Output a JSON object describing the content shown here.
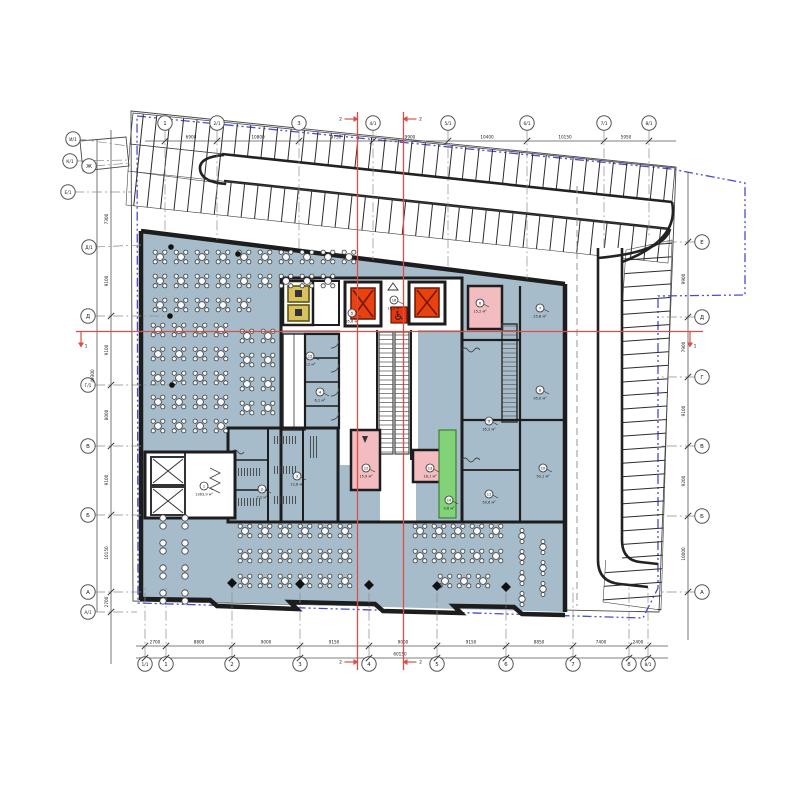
{
  "title": "План этажа — схема расстановки (floor plan with dining layout, core and parking)",
  "colors": {
    "floor": "#a7bcca",
    "wall": "#1d1d1d",
    "elevator_red": "#e8430e",
    "accent_red": "#d94f43",
    "stair_pink": "#f2bcc0",
    "exit_green": "#82d378",
    "dumbwaiter_yellow": "#d9c15e",
    "property_blue": "#4a4ad2"
  },
  "axes": {
    "top": {
      "y": 123,
      "items": [
        {
          "label": "1",
          "x": 165,
          "y2": 233
        },
        {
          "label": "2/1",
          "x": 217,
          "y2": 240
        },
        {
          "label": "3",
          "x": 299,
          "y2": 250
        },
        {
          "label": "4/1",
          "x": 373,
          "y2": 260
        },
        {
          "label": "5/1",
          "x": 448,
          "y2": 269
        },
        {
          "label": "6/1",
          "x": 527,
          "y2": 279
        },
        {
          "label": "7/1",
          "x": 604,
          "y2": 250
        },
        {
          "label": "8/1",
          "x": 649,
          "y2": 238
        }
      ]
    },
    "bottom": {
      "y": 664,
      "items": [
        {
          "label": "1/1",
          "x": 145
        },
        {
          "label": "1",
          "x": 166
        },
        {
          "label": "2",
          "x": 232
        },
        {
          "label": "3",
          "x": 300
        },
        {
          "label": "4",
          "x": 369
        },
        {
          "label": "5",
          "x": 437
        },
        {
          "label": "6",
          "x": 506
        },
        {
          "label": "7",
          "x": 573
        },
        {
          "label": "8",
          "x": 629
        },
        {
          "label": "8/1",
          "x": 648
        }
      ]
    },
    "left": {
      "x": 88,
      "items": [
        {
          "label": "Д",
          "y": 316,
          "x2": 168
        },
        {
          "label": "Г/1",
          "y": 385,
          "x2": 170
        },
        {
          "label": "В",
          "y": 446,
          "x2": 141
        },
        {
          "label": "Б",
          "y": 515,
          "x2": 141
        },
        {
          "label": "А",
          "y": 592,
          "x2": 141
        },
        {
          "label": "А/1",
          "y": 612,
          "x2": 137
        }
      ]
    },
    "right": {
      "x": 702,
      "items": [
        {
          "label": "Е",
          "y": 242,
          "x2": 658
        },
        {
          "label": "Д",
          "y": 317,
          "x2": 658
        },
        {
          "label": "Г",
          "y": 377,
          "x2": 658
        },
        {
          "label": "В",
          "y": 446,
          "x2": 660
        },
        {
          "label": "Б",
          "y": 516,
          "x2": 660
        },
        {
          "label": "А",
          "y": 592,
          "x2": 662
        }
      ]
    },
    "corner": [
      {
        "label": "И/1",
        "x": 73,
        "y": 139,
        "x2": 128,
        "y2": 146
      },
      {
        "label": "К/1",
        "x": 70,
        "y": 161,
        "x2": 128,
        "y2": 160
      },
      {
        "label": "Ж",
        "x": 89,
        "y": 166,
        "x2": 130,
        "y2": 163
      },
      {
        "label": "Е/1",
        "x": 68,
        "y": 192,
        "x2": 131,
        "y2": 192
      },
      {
        "label": "Д/1",
        "x": 89,
        "y": 247,
        "x2": 141,
        "y2": 245
      }
    ]
  },
  "dimensions": {
    "top": [
      {
        "x": 191,
        "t": "6900"
      },
      {
        "x": 258,
        "t": "10800"
      },
      {
        "x": 336,
        "t": "9750"
      },
      {
        "x": 410,
        "t": "9900"
      },
      {
        "x": 487,
        "t": "10400"
      },
      {
        "x": 565,
        "t": "10150"
      },
      {
        "x": 626,
        "t": "5950"
      }
    ],
    "bottom": [
      {
        "x": 155,
        "t": "2700"
      },
      {
        "x": 199,
        "t": "8800"
      },
      {
        "x": 266,
        "t": "9000"
      },
      {
        "x": 334,
        "t": "9150"
      },
      {
        "x": 403,
        "t": "9000"
      },
      {
        "x": 471,
        "t": "9150"
      },
      {
        "x": 539,
        "t": "8850"
      },
      {
        "x": 601,
        "t": "7400"
      },
      {
        "x": 638,
        "t": "2400"
      }
    ],
    "bottom_total": {
      "x": 400,
      "t": "60150"
    },
    "left": [
      {
        "y": 219,
        "t": "7300"
      },
      {
        "y": 281,
        "t": "9100"
      },
      {
        "y": 350,
        "t": "9100"
      },
      {
        "y": 415,
        "t": "8000"
      },
      {
        "y": 480,
        "t": "9100"
      },
      {
        "y": 553,
        "t": "10150"
      },
      {
        "y": 602,
        "t": "2700"
      }
    ],
    "left_total": {
      "y": 376,
      "t": "49300"
    },
    "right": [
      {
        "y": 279,
        "t": "9900"
      },
      {
        "y": 347,
        "t": "7900"
      },
      {
        "y": 411,
        "t": "9100"
      },
      {
        "y": 481,
        "t": "9200"
      },
      {
        "y": 554,
        "t": "10000"
      }
    ]
  },
  "room_labels": [
    {
      "x": 204,
      "y": 486,
      "n": "1",
      "a": "1363,9 м²"
    },
    {
      "x": 262,
      "y": 489,
      "n": "2",
      "a": "7,2 м²"
    },
    {
      "x": 297,
      "y": 476,
      "n": "3",
      "a": "12,8 м²"
    },
    {
      "x": 320,
      "y": 392,
      "n": "4",
      "a": "6,1 м²"
    },
    {
      "x": 352,
      "y": 313,
      "n": "5",
      "a": "35,6 м²"
    },
    {
      "x": 480,
      "y": 303,
      "n": "6",
      "a": "15,2 м²"
    },
    {
      "x": 540,
      "y": 308,
      "n": "7",
      "a": "25,8 м²"
    },
    {
      "x": 540,
      "y": 390,
      "n": "8",
      "a": "95,0 м²"
    },
    {
      "x": 489,
      "y": 421,
      "n": "9",
      "a": "35,2 м²"
    },
    {
      "x": 543,
      "y": 468,
      "n": "10",
      "a": "50,1 м²"
    },
    {
      "x": 489,
      "y": 494,
      "n": "11",
      "a": "50,6 м²"
    },
    {
      "x": 366,
      "y": 468,
      "n": "12",
      "a": "15,9 м²"
    },
    {
      "x": 430,
      "y": 468,
      "n": "13",
      "a": "16,1 м²"
    },
    {
      "x": 449,
      "y": 500,
      "n": "14",
      "a": "9,6 м²"
    },
    {
      "x": 310,
      "y": 356,
      "n": "15",
      "a": "4,2 м²"
    },
    {
      "x": 394,
      "y": 300,
      "n": "16",
      "a": "18,3 м²"
    }
  ],
  "tables": {
    "groups": [
      {
        "type": "t4",
        "x": 160,
        "y": 257,
        "cols": 10,
        "rows": 1,
        "dx": 21,
        "dy": 0
      },
      {
        "type": "t4",
        "x": 160,
        "y": 281,
        "cols": 9,
        "rows": 1,
        "dx": 21,
        "dy": 0
      },
      {
        "type": "t4",
        "x": 160,
        "y": 305,
        "cols": 5,
        "rows": 1,
        "dx": 21,
        "dy": 0
      },
      {
        "type": "t4",
        "x": 158,
        "y": 330,
        "cols": 4,
        "rows": 5,
        "dx": 21,
        "dy": 24
      },
      {
        "type": "t4",
        "x": 247,
        "y": 336,
        "cols": 2,
        "rows": 4,
        "dx": 21,
        "dy": 24
      },
      {
        "type": "t2",
        "x": 163,
        "y": 522,
        "cols": 2,
        "rows": 4,
        "dx": 22,
        "dy": 25
      },
      {
        "type": "t4",
        "x": 245,
        "y": 531,
        "cols": 6,
        "rows": 3,
        "dx": 20,
        "dy": 25
      },
      {
        "type": "t4",
        "x": 420,
        "y": 531,
        "cols": 5,
        "rows": 2,
        "dx": 19,
        "dy": 25
      },
      {
        "type": "t4",
        "x": 445,
        "y": 581,
        "cols": 3,
        "rows": 1,
        "dx": 19,
        "dy": 0
      },
      {
        "type": "t1",
        "x": 522,
        "y": 536,
        "cols": 1,
        "rows": 4,
        "dx": 0,
        "dy": 21
      },
      {
        "type": "t1",
        "x": 543,
        "y": 547,
        "cols": 1,
        "rows": 3,
        "dx": 0,
        "dy": 21
      }
    ]
  },
  "columns": {
    "diamonds": [
      [
        232,
        583
      ],
      [
        300,
        584
      ],
      [
        369,
        585
      ],
      [
        437,
        586
      ],
      [
        506,
        587
      ]
    ],
    "dots": [
      [
        171,
        247
      ],
      [
        238,
        254
      ],
      [
        170,
        316
      ],
      [
        172,
        385
      ]
    ]
  },
  "sections": {
    "vertical": [
      {
        "x": 357.5,
        "label": "2",
        "y1": 112,
        "y2": 670
      },
      {
        "x": 403.5,
        "label": "2",
        "y1": 112,
        "y2": 670
      }
    ],
    "horizontal": {
      "y": 331.5,
      "label": "1",
      "x1": 76,
      "x2": 703
    }
  }
}
